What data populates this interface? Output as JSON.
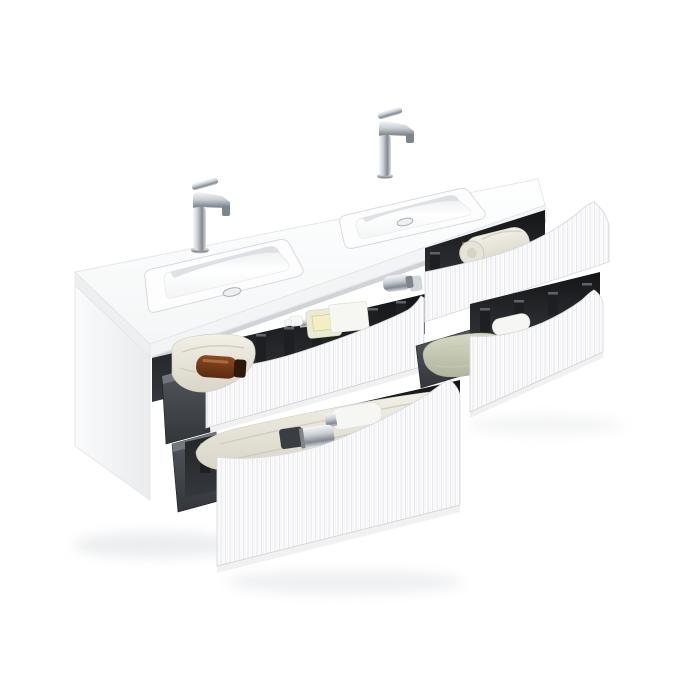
{
  "scene": {
    "description": "Wall-mounted double-sink bathroom vanity in matte white with vertical fluted drawer fronts; four drawers open showing dark grey organisers, rolled towels and toiletry bottles; two chrome single-lever basin mixers on a white ceramic double washbasin top.",
    "objects": [
      "ceramic-double-basin-countertop",
      "chrome-mixer-tap-left",
      "chrome-mixer-tap-right",
      "cabinet-side-panel",
      "drawer-top-left",
      "drawer-top-right",
      "drawer-bottom-left",
      "drawer-bottom-right",
      "divider-fins",
      "cream-towels",
      "sage-towel",
      "rolled-towel",
      "amber-bottle",
      "soap-pump-bottle",
      "storage-box",
      "perfume-bottles",
      "chrome-spray-bottle",
      "lotion-pump-bottle",
      "white-bottle"
    ]
  },
  "colors": {
    "background": "#ffffff",
    "surface_white": "#fdfdfe",
    "edge_soft": "#e4e7ea",
    "edge_strong": "#d6dade",
    "interior_top": "#141517",
    "interior_bottom": "#35383c",
    "fin": "#1d1f22",
    "fin_highlight": "#5e6269",
    "box_dark": "#33363a",
    "box_light": "#54585e",
    "chrome_light": "#f5f7f9",
    "chrome_mid": "#c9ced3",
    "chrome_dark": "#7e858d",
    "towel_light": "#f2f0e8",
    "towel_mid": "#d9d5c7",
    "towel_shadow": "#c9c5b6",
    "towel_sage_light": "#d6d8c5",
    "towel_sage_dark": "#b1b59c",
    "amber": "#7a3c17",
    "amber_dark": "#2c1a0c",
    "soap_body": "#e9ebd2",
    "soap_label": "#f3efc2",
    "plastic_white": "#f6f6f3",
    "shadow": "#d9dcdf"
  }
}
